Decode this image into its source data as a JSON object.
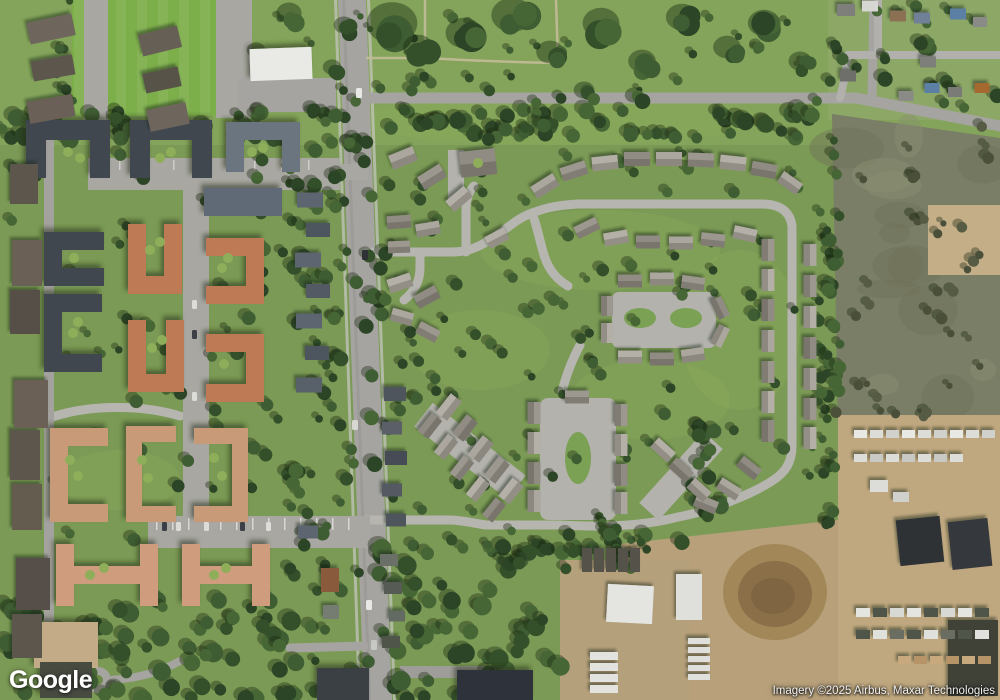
{
  "map": {
    "view_type": "satellite",
    "logo_text": "Google",
    "attribution_text": "Imagery ©2025 Airbus, Maxar Technologies"
  },
  "palette": {
    "grass": "#7b9a55",
    "park_grass": "#83a45a",
    "sports_field": "#7cae4a",
    "tree_dark": "#3d5a32",
    "main_road": "#a5a4a0",
    "residential_street": "#b6b5af",
    "parking": "#a8a7a2",
    "dark_roof": "#3f4650",
    "blue_gray_roof": "#6b7580",
    "orange_roof": "#bd7a55",
    "salmon_roof": "#cf9d7d",
    "townhome_roof": "#aba79f",
    "white_building": "#e9eae6",
    "dirt_yard": "#bfa87f",
    "scrub_field": "#7b7e66"
  }
}
